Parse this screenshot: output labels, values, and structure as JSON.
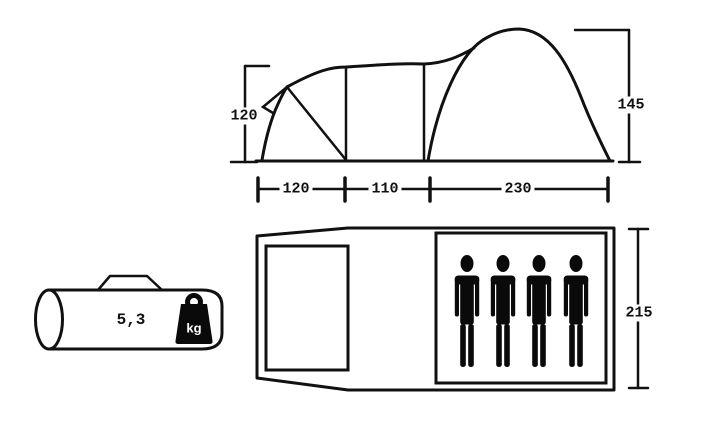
{
  "side_view": {
    "height_left": "120",
    "height_right": "145",
    "base_widths": [
      "120",
      "110",
      "230"
    ]
  },
  "floor_plan": {
    "depth": "215",
    "person_count": 4
  },
  "carry_bag": {
    "weight": "5,3",
    "unit": "kg"
  },
  "icons": {
    "person": "person-silhouette",
    "weight": "kg-weight-tag"
  },
  "colors": {
    "line": "#111111",
    "background": "#ffffff",
    "icon_fill": "#0a0a0a",
    "unit_text": "#ffffff"
  }
}
